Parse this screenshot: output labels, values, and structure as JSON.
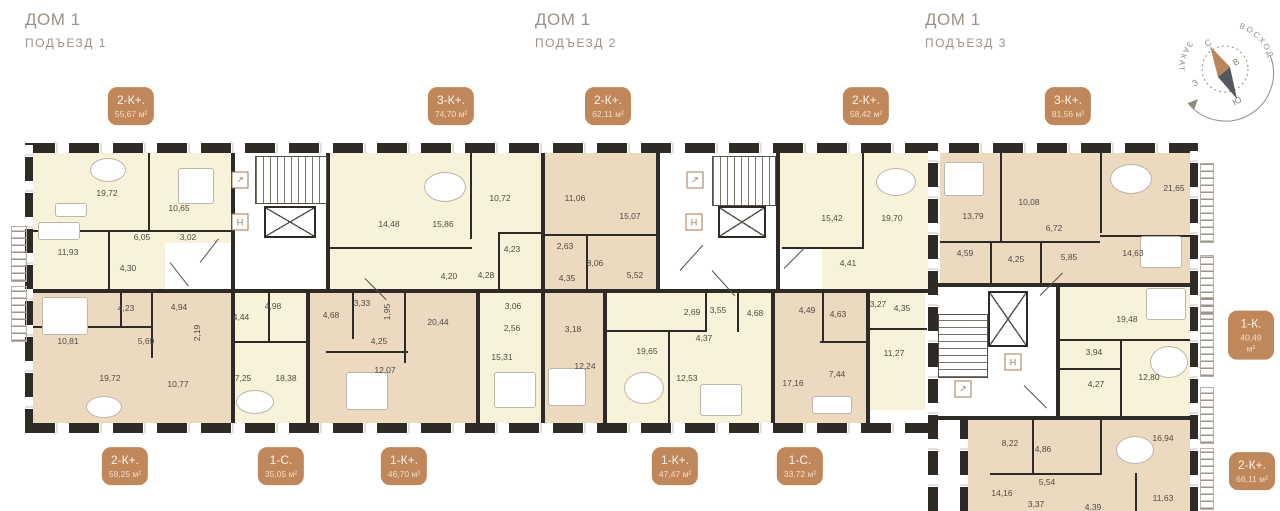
{
  "headers": [
    {
      "title": "ДОМ 1",
      "subtitle": "ПОДЪЕЗД 1"
    },
    {
      "title": "ДОМ 1",
      "subtitle": "ПОДЪЕЗД 2"
    },
    {
      "title": "ДОМ 1",
      "subtitle": "ПОДЪЕЗД 3"
    }
  ],
  "compass": {
    "north": "С",
    "east": "В",
    "south": "Ю",
    "west": "З",
    "sunrise": "ВОСХОД",
    "sunset": "ЗАКАТ"
  },
  "colors": {
    "badge": "#c0885a",
    "wall": "#2e2b27",
    "room_yellow": "#f7f2d9",
    "room_tan": "#ecdac0",
    "header_text": "#9c9186"
  },
  "badges": [
    {
      "label": "2-К+.",
      "area": "55,67 м²",
      "x": 131,
      "y": 106
    },
    {
      "label": "3-К+.",
      "area": "74,70 м²",
      "x": 451,
      "y": 106
    },
    {
      "label": "2-К+.",
      "area": "62,11 м²",
      "x": 608,
      "y": 106
    },
    {
      "label": "2-К+.",
      "area": "58,42 м²",
      "x": 866,
      "y": 106
    },
    {
      "label": "3-К+.",
      "area": "81,56 м²",
      "x": 1068,
      "y": 106
    },
    {
      "label": "1-К.",
      "area": "40,49 м²",
      "x": 1251,
      "y": 335
    },
    {
      "label": "2-К+.",
      "area": "58,25 м²",
      "x": 125,
      "y": 466
    },
    {
      "label": "1-С.",
      "area": "35,05 м²",
      "x": 281,
      "y": 466
    },
    {
      "label": "1-К+.",
      "area": "46,70 м²",
      "x": 404,
      "y": 466
    },
    {
      "label": "1-К+.",
      "area": "47,47 м²",
      "x": 675,
      "y": 466
    },
    {
      "label": "1-С.",
      "area": "33,72 м²",
      "x": 800,
      "y": 466
    },
    {
      "label": "2-К+.",
      "area": "66,11 м²",
      "x": 1252,
      "y": 471
    }
  ],
  "rooms": [
    {
      "t": "19,72",
      "x": 107,
      "y": 193
    },
    {
      "t": "10,65",
      "x": 179,
      "y": 208
    },
    {
      "t": "11,93",
      "x": 68,
      "y": 252
    },
    {
      "t": "6,05",
      "x": 142,
      "y": 237
    },
    {
      "t": "3,02",
      "x": 188,
      "y": 237
    },
    {
      "t": "4,30",
      "x": 128,
      "y": 268
    },
    {
      "t": "4,23",
      "x": 126,
      "y": 308
    },
    {
      "t": "4,94",
      "x": 179,
      "y": 307
    },
    {
      "t": "2,19",
      "x": 197,
      "y": 333,
      "v": 1
    },
    {
      "t": "10,81",
      "x": 68,
      "y": 341
    },
    {
      "t": "5,69",
      "x": 146,
      "y": 341
    },
    {
      "t": "19,72",
      "x": 110,
      "y": 378
    },
    {
      "t": "10,77",
      "x": 178,
      "y": 384
    },
    {
      "t": "4,44",
      "x": 241,
      "y": 317
    },
    {
      "t": "4,98",
      "x": 273,
      "y": 306
    },
    {
      "t": "7,25",
      "x": 243,
      "y": 378
    },
    {
      "t": "18,38",
      "x": 286,
      "y": 378
    },
    {
      "t": "14,48",
      "x": 389,
      "y": 224
    },
    {
      "t": "15,86",
      "x": 443,
      "y": 224
    },
    {
      "t": "10,72",
      "x": 500,
      "y": 198
    },
    {
      "t": "4,23",
      "x": 512,
      "y": 249
    },
    {
      "t": "4,20",
      "x": 449,
      "y": 276
    },
    {
      "t": "4,28",
      "x": 486,
      "y": 275
    },
    {
      "t": "3,33",
      "x": 362,
      "y": 303
    },
    {
      "t": "4,68",
      "x": 331,
      "y": 315
    },
    {
      "t": "1,95",
      "x": 387,
      "y": 312,
      "v": 1
    },
    {
      "t": "20,44",
      "x": 438,
      "y": 322
    },
    {
      "t": "4,25",
      "x": 379,
      "y": 341
    },
    {
      "t": "12,07",
      "x": 385,
      "y": 370
    },
    {
      "t": "3,06",
      "x": 513,
      "y": 306
    },
    {
      "t": "2,56",
      "x": 512,
      "y": 328
    },
    {
      "t": "15,31",
      "x": 502,
      "y": 357
    },
    {
      "t": "11,06",
      "x": 575,
      "y": 198
    },
    {
      "t": "15,07",
      "x": 630,
      "y": 216
    },
    {
      "t": "2,63",
      "x": 565,
      "y": 246
    },
    {
      "t": "8,06",
      "x": 595,
      "y": 263
    },
    {
      "t": "4,35",
      "x": 567,
      "y": 278
    },
    {
      "t": "5,52",
      "x": 635,
      "y": 275
    },
    {
      "t": "3,18",
      "x": 573,
      "y": 329
    },
    {
      "t": "12,24",
      "x": 585,
      "y": 366
    },
    {
      "t": "15,42",
      "x": 832,
      "y": 218
    },
    {
      "t": "19,70",
      "x": 892,
      "y": 218
    },
    {
      "t": "4,41",
      "x": 848,
      "y": 263
    },
    {
      "t": "2,69",
      "x": 692,
      "y": 312
    },
    {
      "t": "3,55",
      "x": 718,
      "y": 310
    },
    {
      "t": "4,68",
      "x": 755,
      "y": 313
    },
    {
      "t": "4,49",
      "x": 807,
      "y": 310
    },
    {
      "t": "4,63",
      "x": 838,
      "y": 314
    },
    {
      "t": "3,27",
      "x": 878,
      "y": 304
    },
    {
      "t": "4,35",
      "x": 902,
      "y": 308
    },
    {
      "t": "4,37",
      "x": 704,
      "y": 338
    },
    {
      "t": "19,65",
      "x": 647,
      "y": 351
    },
    {
      "t": "12,53",
      "x": 687,
      "y": 378
    },
    {
      "t": "17,16",
      "x": 793,
      "y": 383
    },
    {
      "t": "7,44",
      "x": 837,
      "y": 374
    },
    {
      "t": "11,27",
      "x": 894,
      "y": 353
    },
    {
      "t": "13,79",
      "x": 973,
      "y": 216
    },
    {
      "t": "10,08",
      "x": 1029,
      "y": 202
    },
    {
      "t": "21,65",
      "x": 1174,
      "y": 188
    },
    {
      "t": "6,72",
      "x": 1054,
      "y": 228
    },
    {
      "t": "4,59",
      "x": 965,
      "y": 253
    },
    {
      "t": "4,25",
      "x": 1016,
      "y": 259
    },
    {
      "t": "5,85",
      "x": 1069,
      "y": 257
    },
    {
      "t": "14,63",
      "x": 1133,
      "y": 253
    },
    {
      "t": "19,48",
      "x": 1127,
      "y": 319
    },
    {
      "t": "3,94",
      "x": 1094,
      "y": 352
    },
    {
      "t": "4,27",
      "x": 1096,
      "y": 384
    },
    {
      "t": "12,80",
      "x": 1149,
      "y": 377
    },
    {
      "t": "8,22",
      "x": 1010,
      "y": 443
    },
    {
      "t": "4,86",
      "x": 1043,
      "y": 449
    },
    {
      "t": "16,94",
      "x": 1163,
      "y": 438
    },
    {
      "t": "5,54",
      "x": 1047,
      "y": 482
    },
    {
      "t": "14,16",
      "x": 1002,
      "y": 493
    },
    {
      "t": "3,37",
      "x": 1036,
      "y": 504
    },
    {
      "t": "11,63",
      "x": 1163,
      "y": 498
    },
    {
      "t": "4,39",
      "x": 1093,
      "y": 507
    }
  ],
  "icons": [
    {
      "g": "↗",
      "x": 240,
      "y": 180,
      "name": "riser-arrow-icon"
    },
    {
      "g": "Н",
      "x": 240,
      "y": 222,
      "name": "elevator-icon"
    },
    {
      "g": "↗",
      "x": 695,
      "y": 180,
      "name": "riser-arrow-icon"
    },
    {
      "g": "Н",
      "x": 694,
      "y": 222,
      "name": "elevator-icon"
    },
    {
      "g": "↗",
      "x": 963,
      "y": 389,
      "name": "riser-arrow-icon"
    },
    {
      "g": "Н",
      "x": 1013,
      "y": 362,
      "name": "elevator-icon"
    }
  ]
}
